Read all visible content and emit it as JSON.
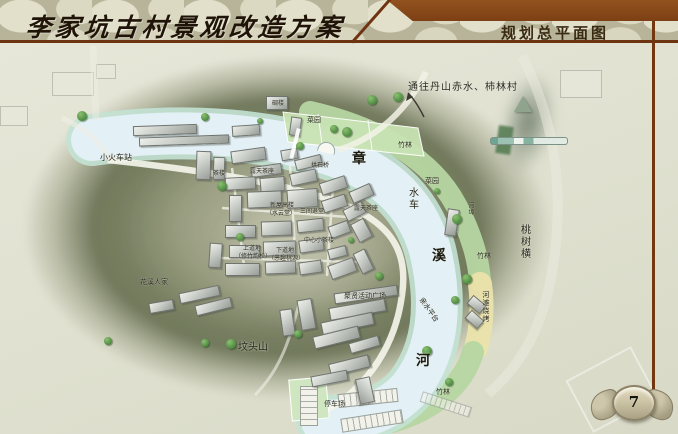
{
  "header": {
    "title": "李家坑古村景观改造方案",
    "section_title": "规划总平面图"
  },
  "footer": {
    "page_number": "7"
  },
  "icons": {
    "north_arrow": "north-arrow-triangle",
    "scale_bar": "map-scale-bar",
    "route_arrow": "curved-up-arrow",
    "page_emblem": "stone-wings-cartouche",
    "tree": "round-tree-symbol",
    "arch_bridge": "stone-arch-bridge-symbol"
  },
  "colors": {
    "header_band_brown": "#8a4a1c",
    "rule_brown": "#6e3310",
    "stone_texture": "#cfccb2",
    "hill_olive": "#6c7455",
    "river_blue": "#e3f0f6",
    "bank_teal": "#c3e2d4",
    "grass_green": "#b6d6a1",
    "sand_yellow": "#ebe3ab",
    "building_gray": "#c4c8c3",
    "tree_green": "#4e8a42"
  },
  "map": {
    "route_annotation": "通往丹山赤水、柿林村",
    "river_name": "章溪河",
    "labels": [
      {
        "text": "小火车站",
        "x": 100,
        "y": 154,
        "s": 8
      },
      {
        "text": "碉楼",
        "x": 272,
        "y": 100,
        "s": 6
      },
      {
        "text": "菜园",
        "x": 307,
        "y": 116,
        "s": 7
      },
      {
        "text": "竹林",
        "x": 398,
        "y": 141,
        "s": 7
      },
      {
        "text": "茶楼",
        "x": 213,
        "y": 170,
        "s": 6
      },
      {
        "text": "露天茶座",
        "x": 250,
        "y": 168,
        "s": 6
      },
      {
        "text": "拱石桥",
        "x": 311,
        "y": 162,
        "s": 6
      },
      {
        "text": "章",
        "x": 352,
        "y": 152,
        "s": 14,
        "em": true
      },
      {
        "text": "菜园",
        "x": 425,
        "y": 177,
        "s": 7
      },
      {
        "text": "水车",
        "x": 406,
        "y": 187,
        "s": 10,
        "v": true
      },
      {
        "text": "河埠",
        "x": 468,
        "y": 202,
        "s": 6,
        "v": true
      },
      {
        "text": "桃树横",
        "x": 518,
        "y": 224,
        "s": 10,
        "v": true
      },
      {
        "text": "溪",
        "x": 432,
        "y": 249,
        "s": 14,
        "em": true
      },
      {
        "text": "竹林",
        "x": 477,
        "y": 252,
        "s": 7
      },
      {
        "text": "新屋高楼",
        "x": 270,
        "y": 202,
        "s": 6
      },
      {
        "text": "（水云堂）",
        "x": 266,
        "y": 210,
        "s": 6
      },
      {
        "text": "三间退堂",
        "x": 300,
        "y": 208,
        "s": 6
      },
      {
        "text": "露天茶座",
        "x": 354,
        "y": 205,
        "s": 6
      },
      {
        "text": "中心小茶楼",
        "x": 304,
        "y": 237,
        "s": 6
      },
      {
        "text": "上道地",
        "x": 243,
        "y": 245,
        "s": 6
      },
      {
        "text": "（修竹韵松）",
        "x": 235,
        "y": 253,
        "s": 6
      },
      {
        "text": "下道地",
        "x": 276,
        "y": 247,
        "s": 6
      },
      {
        "text": "（愚趣桃源）",
        "x": 268,
        "y": 255,
        "s": 6
      },
      {
        "text": "聚贤活动广场",
        "x": 344,
        "y": 292,
        "s": 7
      },
      {
        "text": "亲水平台",
        "x": 424,
        "y": 296,
        "s": 7,
        "r": 55
      },
      {
        "text": "河滩烧烤",
        "x": 482,
        "y": 291,
        "s": 7,
        "v": true
      },
      {
        "text": "河",
        "x": 416,
        "y": 354,
        "s": 14,
        "em": true
      },
      {
        "text": "坟头山",
        "x": 238,
        "y": 343,
        "s": 10
      },
      {
        "text": "花溪人家",
        "x": 140,
        "y": 278,
        "s": 7
      },
      {
        "text": "停车场",
        "x": 324,
        "y": 400,
        "s": 7
      },
      {
        "text": "竹林",
        "x": 436,
        "y": 388,
        "s": 7
      }
    ],
    "trees": [
      [
        82,
        116,
        5
      ],
      [
        205,
        117,
        4
      ],
      [
        260,
        121,
        3
      ],
      [
        300,
        146,
        4
      ],
      [
        334,
        129,
        4
      ],
      [
        347,
        132,
        5
      ],
      [
        372,
        100,
        5
      ],
      [
        398,
        97,
        5
      ],
      [
        222,
        186,
        5
      ],
      [
        240,
        237,
        4
      ],
      [
        351,
        240,
        3
      ],
      [
        437,
        191,
        3
      ],
      [
        457,
        219,
        5
      ],
      [
        467,
        279,
        5
      ],
      [
        455,
        300,
        4
      ],
      [
        379,
        276,
        4
      ],
      [
        298,
        334,
        4
      ],
      [
        205,
        343,
        4
      ],
      [
        231,
        344,
        5
      ],
      [
        108,
        341,
        4
      ],
      [
        427,
        351,
        5
      ],
      [
        449,
        382,
        4
      ]
    ],
    "buildings": [
      [
        133,
        125,
        62,
        8,
        -2
      ],
      [
        139,
        136,
        88,
        7,
        -2
      ],
      [
        232,
        125,
        26,
        9,
        -4
      ],
      [
        266,
        96,
        20,
        12,
        0
      ],
      [
        290,
        117,
        9,
        17,
        8
      ],
      [
        196,
        151,
        13,
        27,
        2
      ],
      [
        213,
        157,
        10,
        21,
        2
      ],
      [
        231,
        149,
        33,
        11,
        -8
      ],
      [
        251,
        165,
        29,
        9,
        -8
      ],
      [
        281,
        149,
        15,
        9,
        -10
      ],
      [
        295,
        157,
        25,
        9,
        -14
      ],
      [
        225,
        177,
        29,
        11,
        -3
      ],
      [
        260,
        177,
        23,
        13,
        -5
      ],
      [
        290,
        171,
        25,
        11,
        -12
      ],
      [
        320,
        179,
        25,
        11,
        -18
      ],
      [
        350,
        187,
        21,
        11,
        -24
      ],
      [
        229,
        195,
        11,
        25,
        0
      ],
      [
        247,
        191,
        33,
        15,
        -2
      ],
      [
        287,
        189,
        29,
        17,
        -4
      ],
      [
        322,
        197,
        23,
        11,
        -18
      ],
      [
        344,
        205,
        19,
        11,
        -27
      ],
      [
        225,
        225,
        29,
        11,
        0
      ],
      [
        261,
        221,
        29,
        13,
        -2
      ],
      [
        297,
        219,
        25,
        11,
        -6
      ],
      [
        329,
        223,
        19,
        11,
        -20
      ],
      [
        354,
        220,
        13,
        19,
        -28
      ],
      [
        209,
        243,
        11,
        23,
        4
      ],
      [
        229,
        245,
        29,
        11,
        0
      ],
      [
        263,
        241,
        31,
        13,
        -2
      ],
      [
        299,
        239,
        23,
        11,
        -8
      ],
      [
        328,
        247,
        17,
        9,
        -14
      ],
      [
        225,
        263,
        33,
        11,
        0
      ],
      [
        265,
        261,
        29,
        11,
        -2
      ],
      [
        299,
        261,
        21,
        11,
        -8
      ],
      [
        329,
        261,
        25,
        13,
        -20
      ],
      [
        357,
        250,
        11,
        21,
        -26
      ],
      [
        334,
        289,
        62,
        9,
        -8
      ],
      [
        329,
        303,
        55,
        11,
        -10
      ],
      [
        321,
        317,
        51,
        11,
        -12
      ],
      [
        313,
        331,
        45,
        11,
        -14
      ],
      [
        349,
        339,
        29,
        9,
        -16
      ],
      [
        299,
        299,
        13,
        29,
        -10
      ],
      [
        281,
        309,
        11,
        25,
        -8
      ],
      [
        179,
        289,
        39,
        9,
        -12
      ],
      [
        195,
        301,
        35,
        9,
        -14
      ],
      [
        149,
        301,
        23,
        9,
        -10
      ],
      [
        329,
        359,
        39,
        11,
        -14
      ],
      [
        311,
        373,
        35,
        9,
        -11
      ],
      [
        352,
        383,
        24,
        13,
        78
      ],
      [
        446,
        209,
        10,
        25,
        8
      ],
      [
        468,
        299,
        15,
        9,
        40
      ],
      [
        466,
        314,
        15,
        9,
        42
      ]
    ],
    "faint_blocks": [
      [
        52,
        72,
        40,
        22
      ],
      [
        96,
        64,
        18,
        13
      ],
      [
        0,
        106,
        26,
        18
      ],
      [
        560,
        70,
        40,
        26
      ]
    ]
  }
}
